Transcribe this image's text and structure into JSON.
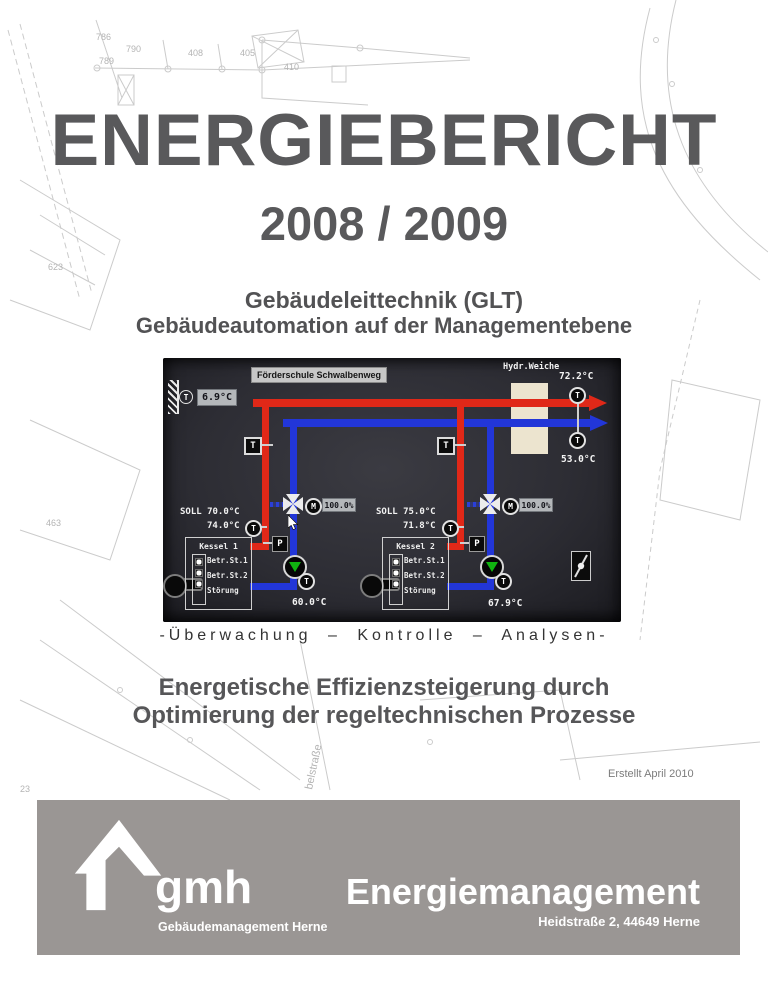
{
  "title": {
    "line1": "ENERGIEBERICHT",
    "line2": "2008 / 2009"
  },
  "subtitle": {
    "line1": "Gebäudeleittechnik (GLT)",
    "line2": "Gebäudeautomation auf der Managementebene"
  },
  "caption": "-Überwachung – Kontrolle – Analysen-",
  "heading2": {
    "line1": "Energetische Effizienzsteigerung durch",
    "line2": "Optimierung der regeltechnischen Prozesse"
  },
  "created": "Erstellt April 2010",
  "scada": {
    "site_label": "Förderschule Schwalbenweg",
    "outside_temp": "6.9°C",
    "hydr_label": "Hydr.Weiche",
    "flow_temp": "72.2°C",
    "return_temp": "53.0°C",
    "letters": {
      "t": "T",
      "p": "P",
      "m": "M"
    },
    "led_labels": [
      "Betr.St.1",
      "Betr.St.2",
      "Störung"
    ],
    "boiler1": {
      "name": "Kessel 1",
      "soll": "SOLL 70.0°C",
      "ist": "74.0°C",
      "valve_pos": "100.0%",
      "return_temp": "60.0°C"
    },
    "boiler2": {
      "name": "Kessel 2",
      "soll": "SOLL 75.0°C",
      "ist": "71.8°C",
      "valve_pos": "100.0%",
      "return_temp": "67.9°C"
    },
    "colors": {
      "flow": "#e02818",
      "return": "#2236d8",
      "panel": "#2d2d34",
      "separator": "#ece4cf",
      "pump": "#10b410"
    }
  },
  "footer": {
    "bg": "#9a9694",
    "logo_text": "gmh",
    "logo_sub": "Gebäudemanagement Herne",
    "title": "Energiemanagement",
    "address": "Heidstraße 2, 44649 Herne"
  },
  "map": {
    "labels": [
      "786",
      "790",
      "789",
      "408",
      "405",
      "410",
      "623",
      "463",
      "23",
      "belstraße"
    ]
  }
}
